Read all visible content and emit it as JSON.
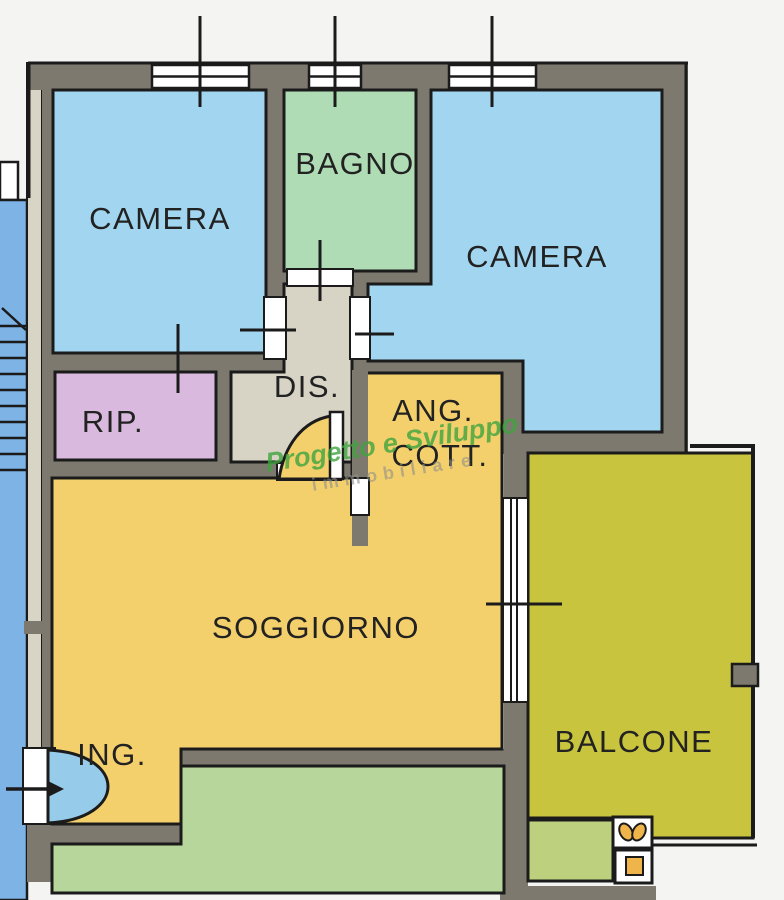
{
  "plan": {
    "type": "apartment-floor-plan",
    "rooms": {
      "camera1": {
        "label": "CAMERA",
        "color": "#a2d5ef"
      },
      "bagno": {
        "label": "BAGNO",
        "color": "#afdcb4"
      },
      "camera2": {
        "label": "CAMERA",
        "color": "#a2d5ef"
      },
      "rip": {
        "label": "RIP.",
        "color": "#d9bade"
      },
      "dis": {
        "label": "DIS.",
        "color": "#d7d3c5"
      },
      "ang_cott": {
        "label_line1": "ANG.",
        "label_line2": "COTT.",
        "color": "#f4d06d"
      },
      "soggiorno": {
        "label": "SOGGIORNO",
        "color": "#f4d06d"
      },
      "ing": {
        "label": "ING.",
        "color": "#f4d06d"
      },
      "balcone": {
        "label": "BALCONE",
        "color": "#c9c43e"
      },
      "green_room": {
        "color": "#b7d69b"
      },
      "balcone_lower": {
        "color": "#bdd07e"
      }
    },
    "watermark": {
      "line1": "Progetto e Sviluppo",
      "line2": "immobiliare",
      "line1_color": "#3fa53f",
      "line2_color": "#8f8f88"
    },
    "colors": {
      "background": "#f4f4f2",
      "wall": "#7d796e",
      "wall_light": "#d8d4c6",
      "outline": "#1b1b1b",
      "stair_blue": "#7eb3e6",
      "door_blue": "#97cbea",
      "window_white": "#ffffff",
      "accent_orange": "#f0b54a",
      "label_text": "#222222"
    }
  }
}
